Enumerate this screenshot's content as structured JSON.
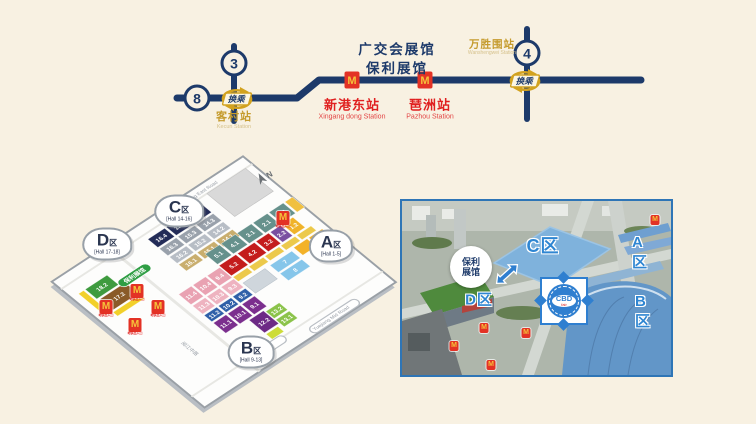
{
  "page": {
    "background": "#f8f1e2"
  },
  "metro_map": {
    "venue_label": {
      "line1": "广交会展馆",
      "line2": "保利展馆"
    },
    "transfer_label": "换乘",
    "station_marker_letter": "M",
    "lines": [
      {
        "id": "line-3",
        "number": "3"
      },
      {
        "id": "line-8",
        "number": "8"
      },
      {
        "id": "line-4",
        "number": "4"
      }
    ],
    "stations": [
      {
        "id": "kecun",
        "zh": "客村站",
        "en": "Kecun Station"
      },
      {
        "id": "xingangdong",
        "zh": "新港东站",
        "en": "Xingang dong Station"
      },
      {
        "id": "pazhou",
        "zh": "琶洲站",
        "en": "Pazhou Station"
      },
      {
        "id": "wanshengwei",
        "zh": "万胜围站",
        "en": "Wanshengwei Station"
      }
    ]
  },
  "floor_plan": {
    "compass": "N",
    "roads": {
      "north_zh": "新港东路",
      "north_en": "Xingang East Road",
      "south_zh": "阅江中路",
      "south_en": "Yuejiang Mid Road"
    },
    "poly_hall_label": "保利展馆",
    "zone_badges": [
      {
        "id": "a",
        "letter": "A",
        "qu": "区",
        "range": "[Hall 1-5]",
        "x": 331,
        "y": 246
      },
      {
        "id": "b",
        "letter": "B",
        "qu": "区",
        "range": "[Hall 9-13]",
        "x": 251,
        "y": 352
      },
      {
        "id": "c",
        "letter": "C",
        "qu": "区",
        "range": "[Hall 14-16]",
        "x": 179,
        "y": 211
      },
      {
        "id": "d",
        "letter": "D",
        "qu": "区",
        "range": "[Hall 17-18]",
        "x": 107,
        "y": 244
      }
    ],
    "hall_groups": [
      {
        "name": "c-upper",
        "fill": "#232c58",
        "cells": [
          {
            "x": 92,
            "y": 6,
            "w": 20,
            "h": 13,
            "label": "16.4"
          },
          {
            "x": 114,
            "y": 6,
            "w": 20,
            "h": 13,
            "label": "15.4"
          },
          {
            "x": 136,
            "y": 6,
            "w": 20,
            "h": 13,
            "label": "14.4"
          }
        ]
      },
      {
        "name": "c-third",
        "fill": "#99a1ab",
        "cells": [
          {
            "x": 92,
            "y": 21,
            "w": 20,
            "h": 11,
            "label": "16.3"
          },
          {
            "x": 114,
            "y": 21,
            "w": 20,
            "h": 11,
            "label": "15.3"
          },
          {
            "x": 136,
            "y": 21,
            "w": 20,
            "h": 11,
            "label": "14.3"
          }
        ]
      },
      {
        "name": "c-second",
        "fill": "#b7bdc5",
        "cells": [
          {
            "x": 92,
            "y": 34,
            "w": 20,
            "h": 10,
            "label": "16.2"
          },
          {
            "x": 114,
            "y": 34,
            "w": 20,
            "h": 10,
            "label": "15.2"
          },
          {
            "x": 136,
            "y": 34,
            "w": 20,
            "h": 10,
            "label": "14.2"
          }
        ]
      },
      {
        "name": "c-first",
        "fill": "#c9ae6e",
        "cells": [
          {
            "x": 92,
            "y": 46,
            "w": 20,
            "h": 10,
            "label": "16.1"
          },
          {
            "x": 114,
            "y": 46,
            "w": 20,
            "h": 10,
            "label": "15.1"
          },
          {
            "x": 136,
            "y": 46,
            "w": 20,
            "h": 10,
            "label": "14.1"
          }
        ]
      },
      {
        "name": "gray-building",
        "fill": "#d9d9d9",
        "stroke": "#c0c0c0",
        "cells": [
          {
            "x": 168,
            "y": 0,
            "w": 46,
            "h": 36,
            "label": ""
          }
        ]
      },
      {
        "name": "d-green",
        "fill": "#3e9b3f",
        "cells": [
          {
            "x": 10,
            "y": 14,
            "w": 26,
            "h": 15,
            "label": "18.2"
          }
        ]
      },
      {
        "name": "d-brown",
        "fill": "#8a5a28",
        "cells": [
          {
            "x": 12,
            "y": 31,
            "w": 30,
            "h": 17,
            "label": "17.2"
          }
        ]
      },
      {
        "name": "d-yellow",
        "fill": "#f2d02a",
        "cells": [
          {
            "x": 2,
            "y": 14,
            "w": 6,
            "h": 34,
            "label": ""
          },
          {
            "x": 10,
            "y": 50,
            "w": 32,
            "h": 6,
            "label": ""
          }
        ]
      },
      {
        "name": "a-teal",
        "fill": "#66918c",
        "cells": [
          {
            "x": 118,
            "y": 52,
            "w": 17,
            "h": 16,
            "label": "5.1"
          },
          {
            "x": 137,
            "y": 52,
            "w": 17,
            "h": 16,
            "label": "4.1"
          },
          {
            "x": 156,
            "y": 52,
            "w": 17,
            "h": 16,
            "label": "3.1"
          },
          {
            "x": 175,
            "y": 52,
            "w": 17,
            "h": 16,
            "label": "2.1"
          },
          {
            "x": 194,
            "y": 52,
            "w": 17,
            "h": 16,
            "label": "1.1"
          }
        ]
      },
      {
        "name": "a-teal-end",
        "fill": "#f0c040",
        "cells": [
          {
            "x": 213,
            "y": 52,
            "w": 9,
            "h": 16,
            "label": ""
          }
        ]
      },
      {
        "name": "a-red",
        "fill": "#c41c1c",
        "cells": [
          {
            "x": 118,
            "y": 70,
            "w": 20,
            "h": 16,
            "label": "5.2"
          },
          {
            "x": 140,
            "y": 70,
            "w": 20,
            "h": 16,
            "label": "4.2"
          },
          {
            "x": 162,
            "y": 70,
            "w": 15,
            "h": 16,
            "label": "3.2"
          }
        ]
      },
      {
        "name": "a-purple",
        "fill": "#7a4fa0",
        "cells": [
          {
            "x": 179,
            "y": 70,
            "w": 12,
            "h": 16,
            "label": "2.2"
          }
        ]
      },
      {
        "name": "a-gold",
        "fill": "#f0b32a",
        "cells": [
          {
            "x": 193,
            "y": 70,
            "w": 13,
            "h": 16,
            "label": "1.2"
          }
        ]
      },
      {
        "name": "a-strip",
        "fill": "#ecc94b",
        "cells": [
          {
            "x": 118,
            "y": 88,
            "w": 17,
            "h": 7,
            "label": ""
          },
          {
            "x": 137,
            "y": 88,
            "w": 17,
            "h": 7,
            "label": ""
          },
          {
            "x": 156,
            "y": 88,
            "w": 17,
            "h": 7,
            "label": ""
          },
          {
            "x": 175,
            "y": 88,
            "w": 17,
            "h": 7,
            "label": ""
          },
          {
            "x": 194,
            "y": 88,
            "w": 17,
            "h": 7,
            "label": ""
          }
        ]
      },
      {
        "name": "mid-cyan",
        "fill": "#86c6ea",
        "cells": [
          {
            "x": 152,
            "y": 99,
            "w": 26,
            "h": 11,
            "label": "7"
          },
          {
            "x": 152,
            "y": 112,
            "w": 26,
            "h": 11,
            "label": "8"
          }
        ]
      },
      {
        "name": "mid-yellow",
        "fill": "#f3b229",
        "cells": [
          {
            "x": 182,
            "y": 97,
            "w": 16,
            "h": 12,
            "label": ""
          },
          {
            "x": 200,
            "y": 97,
            "w": 16,
            "h": 12,
            "label": ""
          },
          {
            "x": 198,
            "y": 111,
            "w": 18,
            "h": 11,
            "label": ""
          }
        ]
      },
      {
        "name": "ribbed",
        "fill": "#cfd6dc",
        "stroke": "#b9c2ca",
        "cells": [
          {
            "x": 120,
            "y": 99,
            "w": 26,
            "h": 16,
            "label": ""
          }
        ]
      },
      {
        "name": "b-pink-4",
        "fill": "#e9a2b2",
        "cells": [
          {
            "x": 68,
            "y": 72,
            "w": 15,
            "h": 16,
            "label": "11.4"
          },
          {
            "x": 85,
            "y": 72,
            "w": 15,
            "h": 16,
            "label": "10.4"
          },
          {
            "x": 102,
            "y": 72,
            "w": 15,
            "h": 16,
            "label": "9.4"
          }
        ]
      },
      {
        "name": "b-pink-3",
        "fill": "#eeb3c0",
        "cells": [
          {
            "x": 68,
            "y": 90,
            "w": 15,
            "h": 13,
            "label": "11.3"
          },
          {
            "x": 85,
            "y": 90,
            "w": 15,
            "h": 13,
            "label": "10.3"
          },
          {
            "x": 102,
            "y": 90,
            "w": 15,
            "h": 13,
            "label": "9.3"
          }
        ]
      },
      {
        "name": "b-blue",
        "fill": "#2f5fa8",
        "cells": [
          {
            "x": 68,
            "y": 105,
            "w": 15,
            "h": 10,
            "label": "11.2"
          },
          {
            "x": 85,
            "y": 105,
            "w": 15,
            "h": 10,
            "label": "10.2"
          },
          {
            "x": 102,
            "y": 105,
            "w": 15,
            "h": 10,
            "label": "9.2"
          }
        ]
      },
      {
        "name": "b-purple",
        "fill": "#7b2f8e",
        "cells": [
          {
            "x": 68,
            "y": 117,
            "w": 15,
            "h": 16,
            "label": "11.1"
          },
          {
            "x": 85,
            "y": 117,
            "w": 15,
            "h": 16,
            "label": "10.1"
          },
          {
            "x": 102,
            "y": 117,
            "w": 15,
            "h": 16,
            "label": "9.1"
          }
        ]
      },
      {
        "name": "b-purple-tall",
        "fill": "#6d2a86",
        "cells": [
          {
            "x": 94,
            "y": 135,
            "w": 17,
            "h": 20,
            "label": "12.2"
          }
        ]
      },
      {
        "name": "b-green",
        "fill": "#8bc34a",
        "cells": [
          {
            "x": 112,
            "y": 137,
            "w": 16,
            "h": 11,
            "label": "13.2"
          },
          {
            "x": 112,
            "y": 150,
            "w": 16,
            "h": 11,
            "label": "13.1"
          }
        ]
      },
      {
        "name": "b-lime",
        "fill": "#cddc39",
        "cells": [
          {
            "x": 94,
            "y": 157,
            "w": 14,
            "h": 8,
            "label": ""
          }
        ]
      }
    ],
    "metro_entrances": {
      "letter": "M",
      "label": "地铁出入口",
      "positions": [
        [
          283,
          218
        ],
        [
          137,
          291
        ],
        [
          106,
          307
        ],
        [
          135,
          325
        ],
        [
          158,
          307
        ]
      ]
    }
  },
  "aerial_view": {
    "zone_labels": [
      {
        "id": "c",
        "text": "C区",
        "x": 141,
        "y": 44,
        "size": 18
      },
      {
        "id": "a",
        "text": "A区",
        "x": 243,
        "y": 52,
        "size": 15
      },
      {
        "id": "b",
        "text": "B区",
        "x": 245,
        "y": 111,
        "size": 15
      },
      {
        "id": "d",
        "text": "D区",
        "x": 77,
        "y": 98,
        "size": 15
      }
    ],
    "poly_badge": {
      "line1": "保利",
      "line2": "展馆",
      "x": 69,
      "y": 66
    },
    "cbd_logo": {
      "text": "CBD",
      "sub": "fair",
      "x": 162,
      "y": 100
    },
    "metro_icons": {
      "letter": "M",
      "positions": [
        [
          253,
          19
        ],
        [
          124,
          132
        ],
        [
          82,
          127
        ],
        [
          52,
          145
        ],
        [
          89,
          164
        ]
      ]
    }
  },
  "colors": {
    "navy": "#1d3a6a",
    "gold": "#d2a21f",
    "red": "#e33225",
    "cream": "#f8f1e2",
    "photo_border": "#2e75b6",
    "plan_border": "#9aa0a6"
  }
}
